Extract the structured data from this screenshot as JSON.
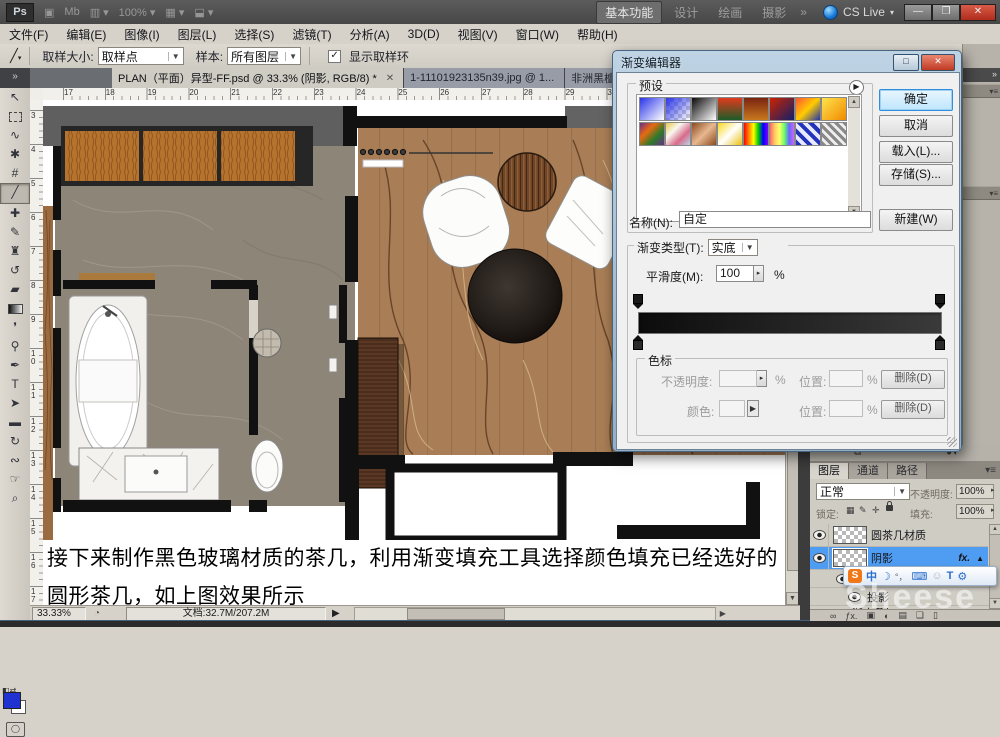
{
  "titlebar": {
    "logo": "Ps",
    "zoom_level": "100%",
    "workspaces": [
      "基本功能",
      "设计",
      "绘画",
      "摄影"
    ],
    "workspace_more": "»",
    "cslive": "CS Live",
    "window_controls": [
      "minimize",
      "restore",
      "close"
    ]
  },
  "menubar": {
    "items": [
      "文件(F)",
      "编辑(E)",
      "图像(I)",
      "图层(L)",
      "选择(S)",
      "滤镜(T)",
      "分析(A)",
      "3D(D)",
      "视图(V)",
      "窗口(W)",
      "帮助(H)"
    ]
  },
  "optionsbar": {
    "sample_size_label": "取样大小:",
    "sample_size_value": "取样点",
    "sample_label": "样本:",
    "sample_value": "所有图层",
    "show_ring_checked": "✓",
    "show_ring_label": "显示取样环"
  },
  "tabbar": {
    "collapse": "»",
    "tabs": [
      {
        "label": "PLAN（平面）异型-FF.psd @ 33.3% (阴影, RGB/8) *",
        "active": true
      },
      {
        "label": "1-11101923135n39.jpg @ 1...",
        "active": false
      },
      {
        "label": "非洲黑檀.jpg @ 100% (图层 ...",
        "active": false
      }
    ]
  },
  "toolbar": {
    "tools": [
      "move-tool",
      "rectangular-marquee-tool",
      "lasso-tool",
      "quick-selection-tool",
      "crop-tool",
      "eyedropper-tool",
      "spot-healing-brush-tool",
      "brush-tool",
      "clone-stamp-tool",
      "history-brush-tool",
      "eraser-tool",
      "gradient-tool",
      "blur-tool",
      "dodge-tool",
      "pen-tool",
      "type-tool",
      "path-selection-tool",
      "rectangle-tool",
      "3d-rotate-tool",
      "3d-orbit-tool",
      "hand-tool",
      "zoom-tool"
    ],
    "selected_tool": "eyedropper-tool",
    "foreground_color": "#2032cf",
    "background_color": "#ffffff"
  },
  "rulers": {
    "top": [
      17,
      18,
      19,
      20,
      21,
      22,
      23,
      24,
      25,
      26,
      27,
      28,
      29,
      30,
      31,
      32,
      33,
      34
    ],
    "left": [
      3,
      4,
      5,
      6,
      7,
      8,
      9,
      10,
      11,
      12,
      13,
      14,
      15,
      16,
      17,
      18
    ]
  },
  "document": {
    "text_line1": "接下来制作黑色玻璃材质的茶几，利用渐变填充工具选择颜色填充已经选好的",
    "text_line2": "圆形茶几，如上图效果所示"
  },
  "statusbar": {
    "zoom": "33.33%",
    "doc_info": "文档:32.7M/207.2M"
  },
  "dialog": {
    "title": "渐变编辑器",
    "presets_label": "预设",
    "swatches": [
      {
        "bg": "linear-gradient(135deg,#2a35e8,#ffffff)",
        "transparent": false
      },
      {
        "bg": "linear-gradient(135deg,#2a35e8,rgba(42,53,232,0))",
        "transparent": true
      },
      {
        "bg": "linear-gradient(135deg,#0a0a0a,#ffffff)",
        "transparent": false
      },
      {
        "bg": "linear-gradient(180deg,#e03a1e,#1c5c28)",
        "transparent": false
      },
      {
        "bg": "linear-gradient(180deg,#7a2410,#c8781e)",
        "transparent": false
      },
      {
        "bg": "linear-gradient(135deg,#cc2200,#12206a)",
        "transparent": false
      },
      {
        "bg": "linear-gradient(135deg,#ff5533,#ffcc00,#2233aa)",
        "transparent": false
      },
      {
        "bg": "linear-gradient(135deg,#ffe34d,#f08a00)",
        "transparent": false
      },
      {
        "bg": "linear-gradient(135deg,#6a2d8a,#e86a10,#2a7a2a,#6a2d8a)",
        "transparent": false
      },
      {
        "bg": "linear-gradient(135deg,#e8c84a,#f8f8f0,#d86a8a,#b8d8e8)",
        "transparent": false
      },
      {
        "bg": "linear-gradient(135deg,#8a4a20,#e8b890,#8a4a20)",
        "transparent": false
      },
      {
        "bg": "linear-gradient(135deg,#f8d820,#ffffff,#e8c010)",
        "transparent": false
      },
      {
        "bg": "linear-gradient(90deg,#ff0000,#ff8000,#ffff00,#00cc00,#0000ff,#8000ff)",
        "transparent": false
      },
      {
        "bg": "linear-gradient(90deg,#ff6666,#ffcc66,#ffff66,#66ff66,#6666ff,#cc66ff)",
        "transparent": true
      },
      {
        "bg": "repeating-linear-gradient(45deg,#2233bb 0 4px,#e8e8ff 4px 8px)",
        "transparent": false
      },
      {
        "bg": "repeating-linear-gradient(45deg,#888888 0 3px,#eeeeee 3px 6px)",
        "transparent": false
      }
    ],
    "ok": "确定",
    "cancel": "取消",
    "load": "载入(L)...",
    "save": "存储(S)...",
    "new": "新建(W)",
    "name_label": "名称(N):",
    "name_value": "自定",
    "type_label": "渐变类型(T):",
    "type_value": "实底",
    "smooth_label": "平滑度(M):",
    "smooth_value": "100",
    "percent": "%",
    "gradient_left_color": "#0c0c0c",
    "gradient_right_color": "#3a3a3a",
    "stops_label": "色标",
    "opacity_label": "不透明度:",
    "color_label": "颜色:",
    "location_label": "位置:",
    "delete_label": "删除(D)"
  },
  "right_dock": {
    "collapse": "»"
  },
  "layers_panel": {
    "tabs": [
      {
        "label": "图层",
        "active": true
      },
      {
        "label": "通道",
        "active": false
      },
      {
        "label": "路径",
        "active": false
      }
    ],
    "blend_mode": "正常",
    "opacity_label": "不透明度:",
    "opacity_value": "100%",
    "lock_label": "锁定:",
    "fill_label": "填充:",
    "fill_value": "100%",
    "rows": [
      {
        "type": "layer",
        "name": "圆茶几材质",
        "selected": false
      },
      {
        "type": "layer",
        "name": "阴影",
        "selected": true,
        "fx": "fx."
      },
      {
        "type": "sub",
        "name": "效果",
        "indent": 26
      },
      {
        "type": "sub",
        "name": "投影",
        "indent": 38
      },
      {
        "type": "sub2",
        "name": "渐变叠加",
        "indent": 42
      }
    ],
    "bottom_icons": [
      "link-icon",
      "layer-style-icon",
      "layer-mask-icon",
      "adjustment-layer-icon",
      "group-icon",
      "new-layer-icon",
      "delete-layer-icon"
    ]
  },
  "ime": {
    "sogou_letter": "S",
    "mode_char": "中",
    "icons": [
      "sogou-icon",
      "chinese-mode-icon",
      "fullmoon-mode-icon",
      "punctuation-icon",
      "keyboard-icon",
      "emoji-icon",
      "skin-icon",
      "toolbox-wrench-icon"
    ]
  },
  "watermark": "Sheese"
}
